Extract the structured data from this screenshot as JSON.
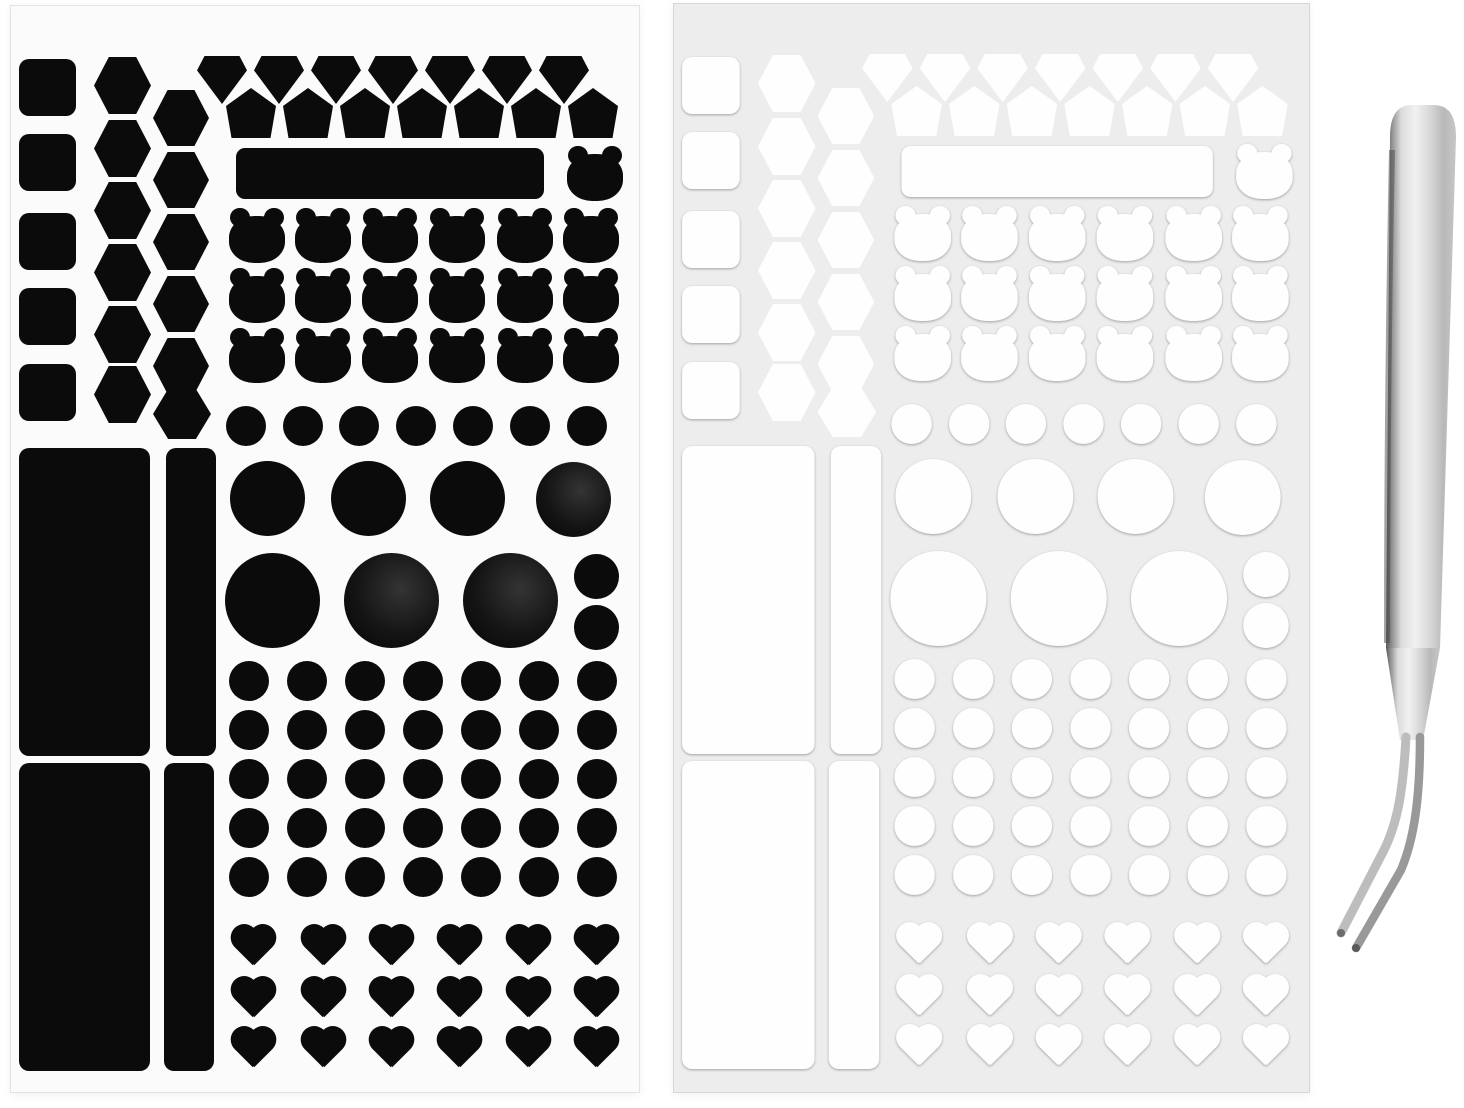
{
  "scene": {
    "width": 1464,
    "height": 1108,
    "background": "#ffffff"
  },
  "palette": {
    "black_sticker": "#0b0b0b",
    "black_sheet_bg": "#fbfbfb",
    "black_sheet_edge": "#e3e3e3",
    "white_sticker": "#fefefe",
    "white_sheet_bg": "#ededed",
    "white_sheet_edge": "#d7d7d7",
    "tweezer_highlight": "#f1f1f1",
    "tweezer_mid": "#c6c6c6",
    "tweezer_dark_edge": "#4a4a4a"
  },
  "sheets": [
    {
      "id": "sticker-sheet-black",
      "x": 10,
      "y": 5,
      "w": 630,
      "h": 1088,
      "bg": "#fbfbfb",
      "edge": "#e3e3e3",
      "style": "dark",
      "sx": 1,
      "sy": 1
    },
    {
      "id": "sticker-sheet-white",
      "x": 673,
      "y": 3,
      "w": 637,
      "h": 1090,
      "bg": "#ededed",
      "edge": "#d7d7d7",
      "style": "light",
      "sx": 1.011,
      "sy": 1.0
    }
  ],
  "layout": {
    "groups": [
      {
        "shape": "rsquare",
        "name": "square-sticker",
        "w": 57,
        "h": 57,
        "r": 10,
        "grid": {
          "cols": [
            8
          ],
          "rows": [
            53,
            128,
            207,
            282,
            358
          ]
        }
      },
      {
        "shape": "hex",
        "name": "hexagon-sticker",
        "w": 57,
        "h": 57,
        "grid": {
          "cols": [
            83
          ],
          "rows": [
            51,
            114,
            176,
            238,
            300,
            360
          ]
        }
      },
      {
        "shape": "hex",
        "name": "hexagon-sticker",
        "w": 56,
        "h": 56,
        "grid": {
          "cols": [
            142
          ],
          "rows": [
            84,
            146,
            208,
            270,
            332
          ]
        }
      },
      {
        "shape": "hex",
        "name": "hexagon-sticker",
        "w": 58,
        "h": 50,
        "items": [
          [
            142,
            383
          ]
        ]
      },
      {
        "shape": "gem",
        "name": "diamond-sticker",
        "w": 50,
        "h": 48,
        "grid": {
          "cols": [
            186,
            243,
            300,
            357,
            414,
            471,
            528
          ],
          "rows": [
            50
          ]
        }
      },
      {
        "shape": "pent",
        "name": "pentagon-sticker",
        "w": 50,
        "h": 50,
        "grid": {
          "cols": [
            215,
            272,
            329,
            386,
            443,
            500,
            557
          ],
          "rows": [
            82
          ]
        }
      },
      {
        "shape": "bar",
        "name": "label-bar-sticker",
        "w": 308,
        "h": 51,
        "r": 9,
        "items": [
          [
            225,
            142
          ]
        ]
      },
      {
        "shape": "bear",
        "name": "bear-sticker",
        "w": 56,
        "h": 55,
        "items": [
          [
            556,
            140
          ]
        ],
        "grid": {
          "cols": [
            218,
            284,
            351,
            418,
            486,
            552
          ],
          "rows": [
            202,
            262,
            322
          ]
        }
      },
      {
        "shape": "circle",
        "name": "dot-sticker",
        "d": 40,
        "grid": {
          "cols": [
            215,
            272,
            328,
            385,
            442,
            499,
            556
          ],
          "rows": [
            400
          ]
        }
      },
      {
        "shape": "circle",
        "name": "dot-sticker",
        "d": 75,
        "items": [
          [
            219,
            455
          ],
          [
            320,
            455
          ],
          [
            419,
            455
          ]
        ]
      },
      {
        "shape": "circle",
        "name": "dot-sticker",
        "d": 75,
        "tex": true,
        "items": [
          [
            525,
            456
          ]
        ]
      },
      {
        "shape": "circle",
        "name": "dot-sticker",
        "d": 95,
        "items": [
          [
            214,
            547
          ]
        ]
      },
      {
        "shape": "circle",
        "name": "dot-sticker",
        "d": 95,
        "tex": true,
        "items": [
          [
            333,
            547
          ],
          [
            452,
            547
          ]
        ]
      },
      {
        "shape": "circle",
        "name": "dot-sticker",
        "d": 45,
        "items": [
          [
            563,
            548
          ],
          [
            563,
            599
          ]
        ]
      },
      {
        "shape": "circle",
        "name": "dot-sticker",
        "d": 40,
        "grid": {
          "cols": [
            218,
            276,
            334,
            392,
            450,
            508,
            566
          ],
          "rows": [
            655,
            704,
            753,
            802,
            851
          ]
        }
      },
      {
        "shape": "heart",
        "name": "heart-sticker",
        "w": 52,
        "h": 47,
        "grid": {
          "cols": [
            216,
            286,
            354,
            422,
            491,
            559
          ],
          "rows": [
            919,
            971,
            1021
          ]
        }
      },
      {
        "shape": "rrect",
        "name": "rectangle-sticker",
        "w": 131,
        "h": 308,
        "r": 10,
        "items": [
          [
            8,
            442
          ],
          [
            8,
            757
          ]
        ]
      },
      {
        "shape": "rrect",
        "name": "rectangle-sticker",
        "w": 50,
        "h": 308,
        "r": 10,
        "items": [
          [
            155,
            442
          ],
          [
            153,
            757
          ]
        ]
      }
    ]
  },
  "tweezers": {
    "x": 1318,
    "y": 95,
    "w": 148,
    "h": 880
  }
}
